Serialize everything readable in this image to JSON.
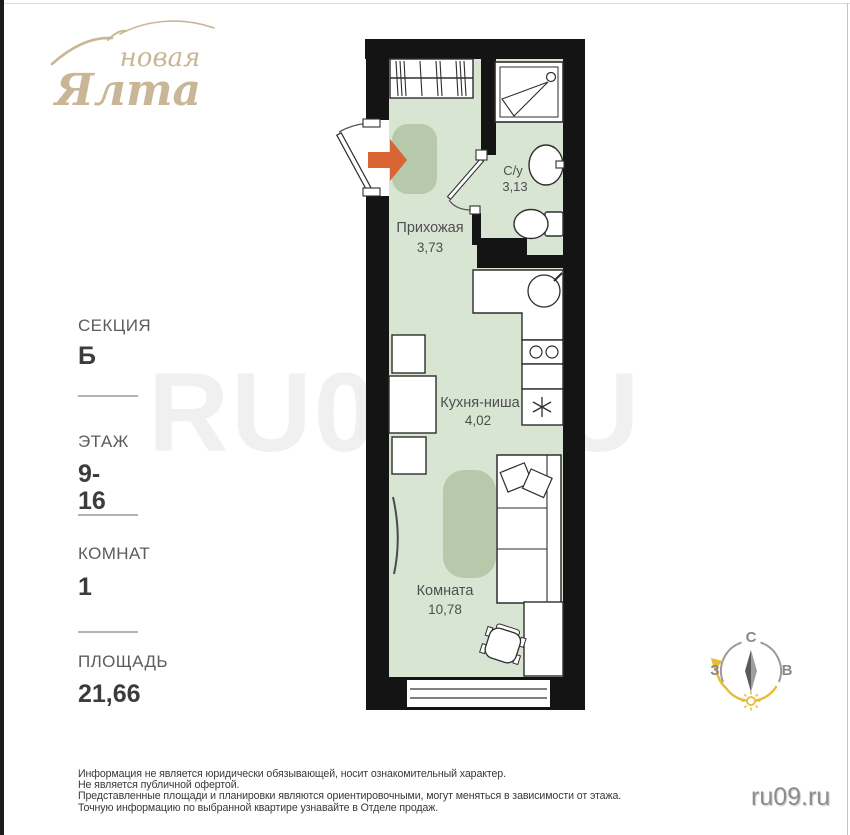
{
  "logo": {
    "line1": "новая",
    "line2": "Ялта"
  },
  "sidebar": {
    "section_label": "СЕКЦИЯ",
    "section_value": "Б",
    "floor_label": "ЭТАЖ",
    "floor_value_line1": "9-",
    "floor_value_line2": "16",
    "rooms_label": "КОМНАТ",
    "rooms_value": "1",
    "area_label": "ПЛОЩАДЬ",
    "area_value": "21,66"
  },
  "plan": {
    "rooms": [
      {
        "name": "Прихожая",
        "area": "3,73"
      },
      {
        "name": "С/у",
        "area": "3,13"
      },
      {
        "name": "Кухня-ниша",
        "area": "4,02"
      },
      {
        "name": "Комната",
        "area": "10,78"
      }
    ]
  },
  "compass": {
    "north": "С",
    "west": "З",
    "east": "В"
  },
  "watermark": "RU09.RU",
  "site": "ru09.ru",
  "disclaimer": [
    "Информация не является юридически обязывающей, носит ознакомительный характер.",
    "Не является публичной офертой.",
    "Представленные площади и планировки являются ориентировочными, могут меняться в зависимости от этажа.",
    "Точную информацию по выбранной квартире узнавайте в Отделе продаж."
  ],
  "colors": {
    "wall_black": "#141414",
    "floor_green": "#d9e5d3",
    "rug_green": "#b6c9ab",
    "accent_orange": "#d96434",
    "logo_tan": "#c9b697",
    "compass_yellow": "#e8bc33"
  }
}
